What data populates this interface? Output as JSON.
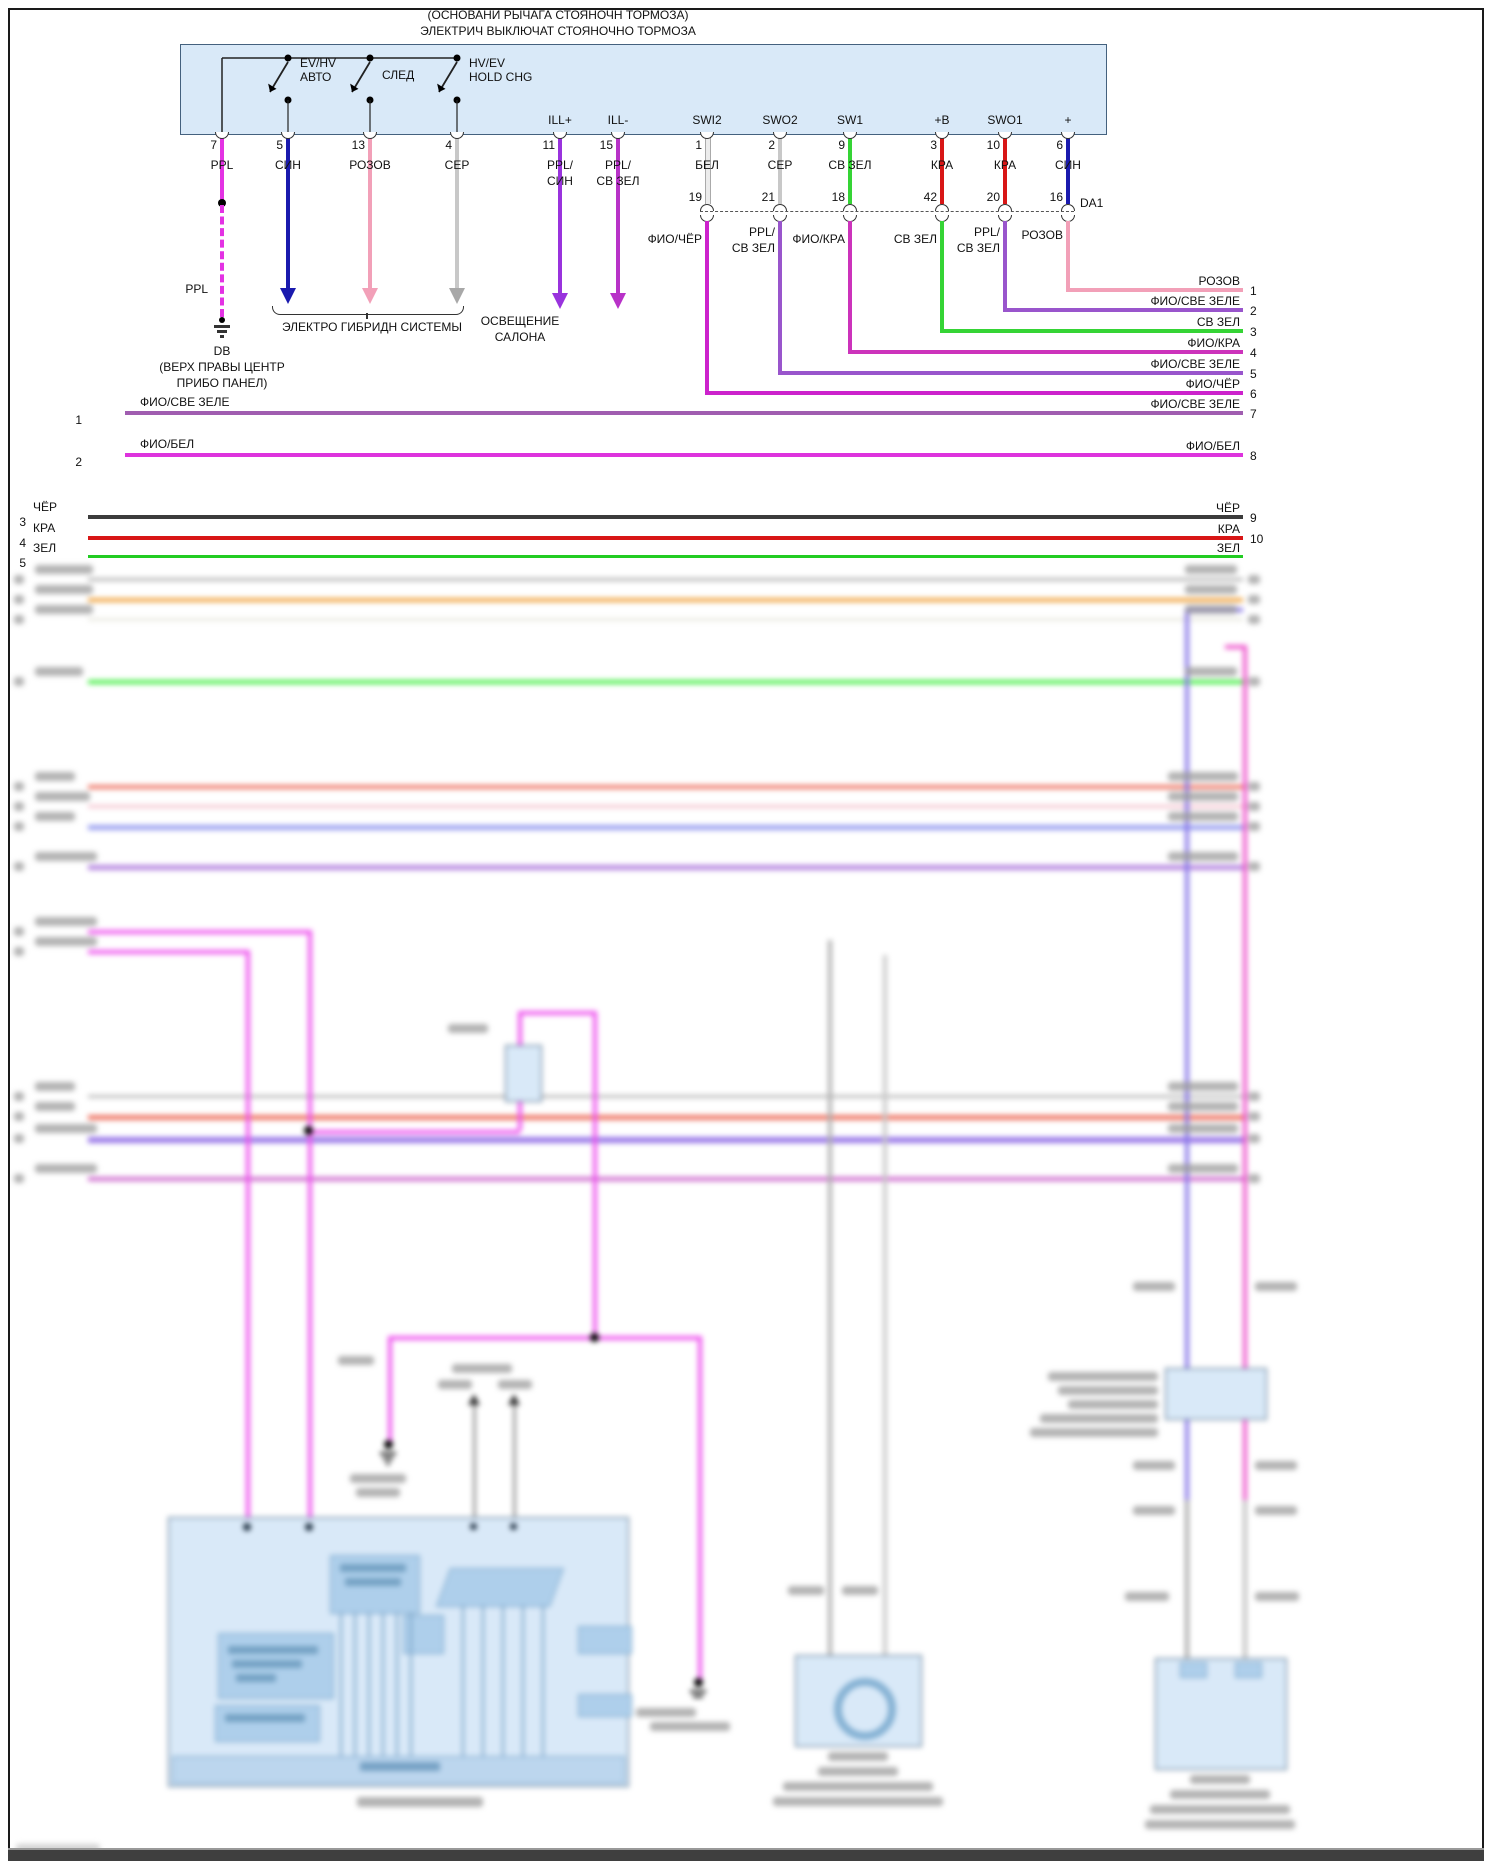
{
  "header": {
    "line1": "(ОСНОВАНИ РЫЧАГА СТОЯНОЧН ТОРМОЗА)",
    "line2": "ЭЛЕКТРИЧ ВЫКЛЮЧАТ СТОЯНОЧНО ТОРМОЗА"
  },
  "switch_box": {
    "switches": [
      {
        "l1": "EV/HV",
        "l2": "АВТО"
      },
      {
        "l1": "СЛЕД",
        "l2": ""
      },
      {
        "l1": "HV/EV",
        "l2": "HOLD CHG"
      }
    ],
    "terminals": [
      "ILL+",
      "ILL-",
      "SWI2",
      "SWO2",
      "SW1",
      "+B",
      "SWO1",
      "+"
    ],
    "pins": [
      {
        "num": "7",
        "l1": "PPL",
        "l2": ""
      },
      {
        "num": "5",
        "l1": "СИН",
        "l2": ""
      },
      {
        "num": "13",
        "l1": "РОЗОВ",
        "l2": ""
      },
      {
        "num": "4",
        "l1": "СЕР",
        "l2": ""
      },
      {
        "num": "11",
        "l1": "PPL/",
        "l2": "СИН"
      },
      {
        "num": "15",
        "l1": "PPL/",
        "l2": "СВ ЗЕЛ"
      },
      {
        "num": "1",
        "l1": "БЕЛ",
        "l2": ""
      },
      {
        "num": "2",
        "l1": "СЕР",
        "l2": ""
      },
      {
        "num": "9",
        "l1": "СВ ЗЕЛ",
        "l2": ""
      },
      {
        "num": "3",
        "l1": "КРА",
        "l2": ""
      },
      {
        "num": "10",
        "l1": "КРА",
        "l2": ""
      },
      {
        "num": "6",
        "l1": "СИН",
        "l2": ""
      }
    ],
    "inline": {
      "numbers": [
        "19",
        "21",
        "18",
        "42",
        "20",
        "16"
      ],
      "label": "DA1"
    },
    "below": [
      {
        "l1": "ФИО/ЧЁР",
        "l2": ""
      },
      {
        "l1": "PPL/",
        "l2": "СВ ЗЕЛ"
      },
      {
        "l1": "ФИО/КРА",
        "l2": ""
      },
      {
        "l1": "СВ ЗЕЛ",
        "l2": ""
      },
      {
        "l1": "PPL/",
        "l2": "СВ ЗЕЛ"
      },
      {
        "l1": "РОЗОВ",
        "l2": ""
      }
    ]
  },
  "left_branch": {
    "ppl": "PPL",
    "ground_name": "DB",
    "ground_loc1": "(ВЕРХ ПРАВЫ ЦЕНТР",
    "ground_loc2": "ПРИБО ПАНЕЛ)",
    "hybrid": "ЭЛЕКТРО ГИБРИДН СИСТЕМЫ",
    "lamp1": "ОСВЕЩЕНИЕ",
    "lamp2": "САЛОНА"
  },
  "left_rows": [
    {
      "num": "1",
      "label": "ФИО/СВЕ ЗЕЛЕ"
    },
    {
      "num": "2",
      "label": "ФИО/БЕЛ"
    },
    {
      "num": "3",
      "label": "ЧЁР"
    },
    {
      "num": "4",
      "label": "КРА"
    },
    {
      "num": "5",
      "label": "ЗЕЛ"
    }
  ],
  "right_rows": [
    {
      "num": "1",
      "label": "РОЗОВ"
    },
    {
      "num": "2",
      "label": "ФИО/СВЕ ЗЕЛЕ"
    },
    {
      "num": "3",
      "label": "СВ ЗЕЛ"
    },
    {
      "num": "4",
      "label": "ФИО/КРА"
    },
    {
      "num": "5",
      "label": "ФИО/СВЕ ЗЕЛЕ"
    },
    {
      "num": "6",
      "label": "ФИО/ЧЁР"
    },
    {
      "num": "7",
      "label": "ФИО/СВЕ ЗЕЛЕ"
    },
    {
      "num": "8",
      "label": "ФИО/БЕЛ"
    },
    {
      "num": "9",
      "label": "ЧЁР"
    },
    {
      "num": "10",
      "label": "КРА"
    },
    {
      "num": "",
      "label": "ЗЕЛ"
    }
  ],
  "colors": {
    "ppl": "#e332e3",
    "sin": "#1a1aae",
    "rozov": "#f2a0b8",
    "ser": "#c8c8c8",
    "ppl_sin": "#9933dd",
    "ppl_svzel": "#b832c8",
    "bel": "#ececec",
    "sv_zel": "#35d435",
    "kra": "#d81616",
    "fio_sve_zele": "#a05db0",
    "fio_bel": "#dd33dd",
    "chyor": "#3c3c3c",
    "zel": "#22cc22",
    "fio_chyor": "#cc22cc",
    "fio_kra": "#cc33bb",
    "box_fill": "#d9e9f8",
    "box_stroke": "#44617e"
  }
}
